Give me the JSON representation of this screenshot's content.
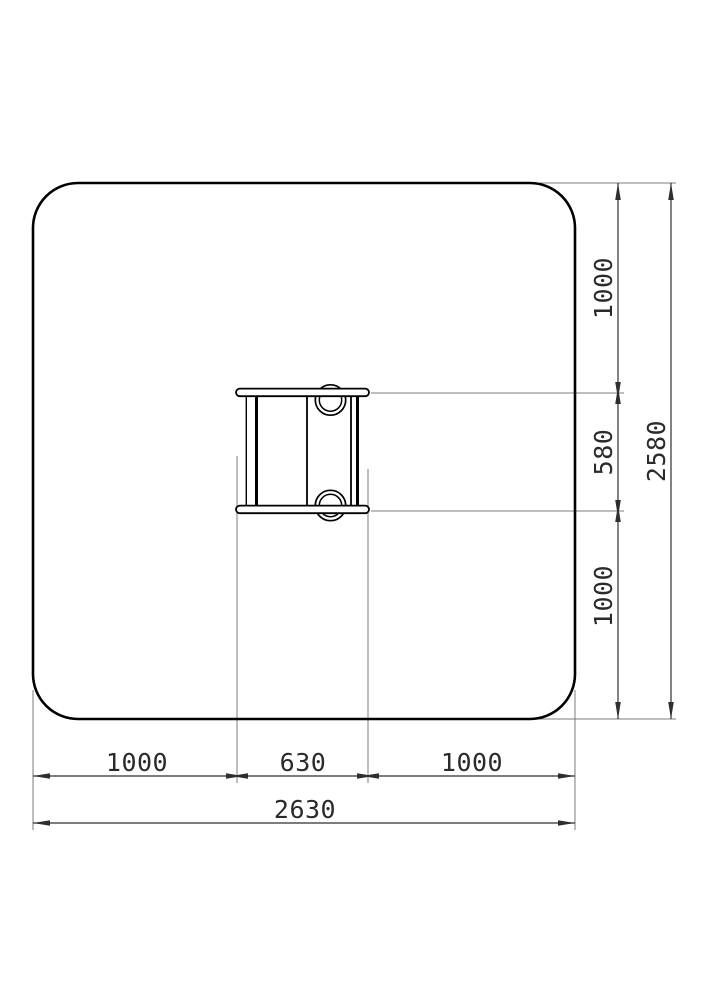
{
  "drawing": {
    "colors": {
      "background": "#ffffff",
      "object_line": "#000000",
      "dimension_line": "#2e2e2e",
      "extension_line": "#7d7d7d",
      "text": "#2a2a2a"
    },
    "dimensions": {
      "vertical": {
        "top": "1000",
        "middle": "580",
        "bottom": "1000",
        "total": "2580"
      },
      "horizontal": {
        "left": "1000",
        "middle": "630",
        "right": "1000",
        "total": "2630"
      }
    }
  }
}
